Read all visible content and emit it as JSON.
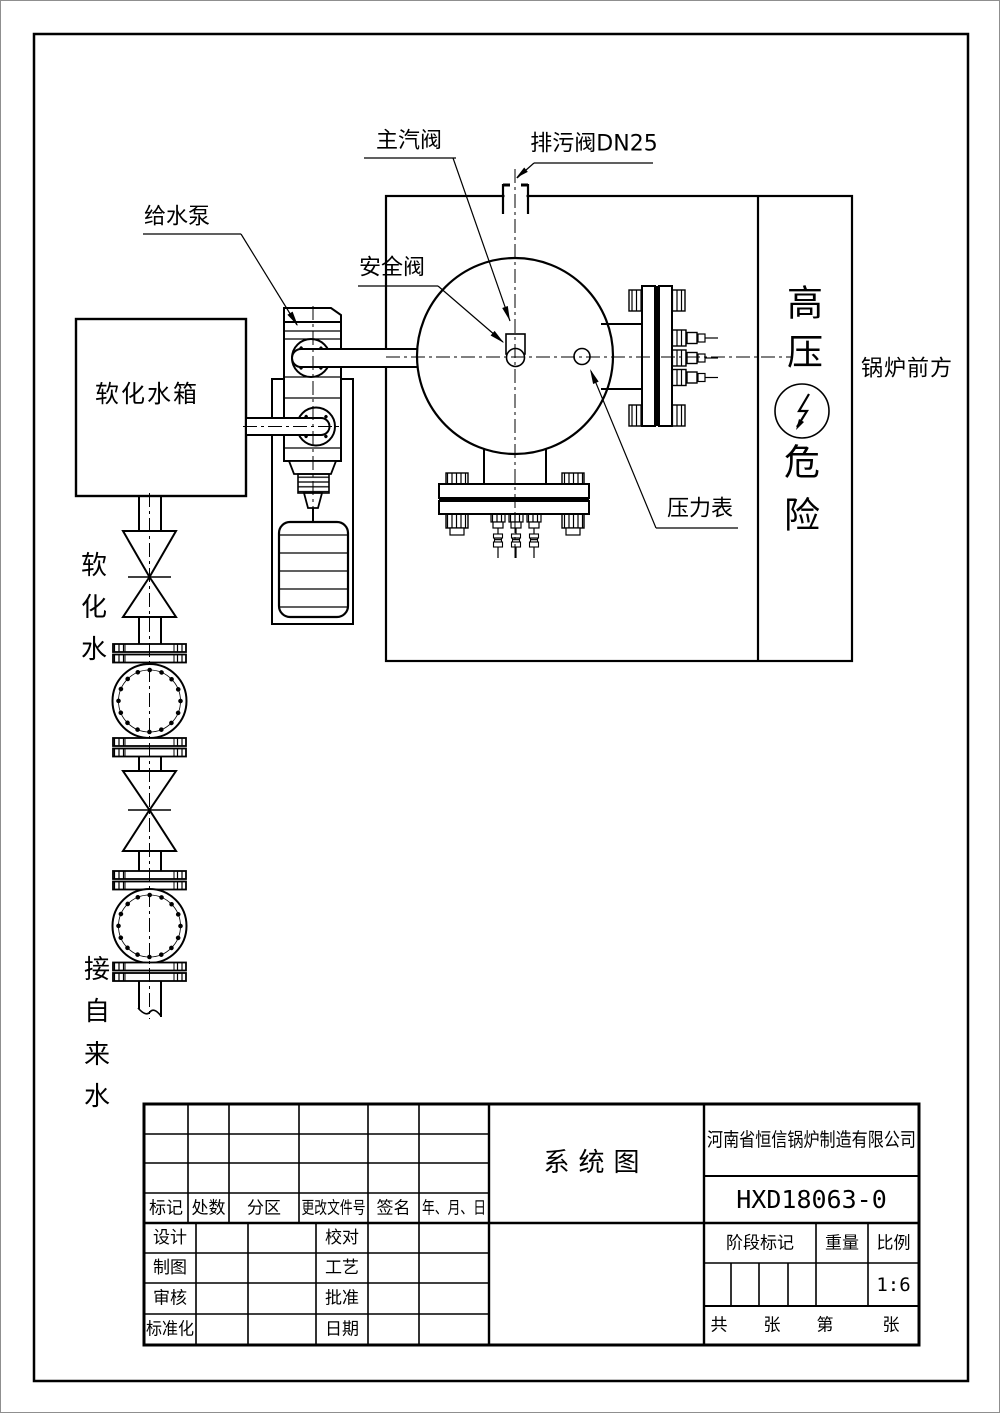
{
  "colors": {
    "line": "#000000",
    "background": "#ffffff"
  },
  "diagram": {
    "labels": {
      "main_steam_valve": "主汽阀",
      "blowdown_valve": "排污阀DN25",
      "feed_water_pump": "给水泵",
      "safety_valve": "安全阀",
      "softened_water_tank": "软化水箱",
      "pressure_gauge": "压力表",
      "boiler_front": "锅炉前方"
    },
    "vertical_labels": {
      "softened_water": [
        "软",
        "化",
        "水"
      ],
      "from_tap_water": [
        "接",
        "自",
        "来",
        "水"
      ],
      "high_pressure_danger": [
        "高",
        "压",
        "危",
        "险"
      ]
    }
  },
  "title_block": {
    "revision_header": [
      "标记",
      "处数",
      "分区",
      "更改文件号",
      "签名",
      "年、月、日"
    ],
    "signature_rows": [
      {
        "left": "设计",
        "right": "校对"
      },
      {
        "left": "制图",
        "right": "工艺"
      },
      {
        "left": "审核",
        "right": "批准"
      },
      {
        "left": "标准化",
        "right": "日期"
      }
    ],
    "drawing_title": "系统图",
    "company": "河南省恒信锅炉制造有限公司",
    "drawing_number": "HXD18063-0",
    "stage_mark_label": "阶段标记",
    "weight_label": "重量",
    "scale_label": "比例",
    "scale_value": "1:6",
    "sheets": {
      "total_label": "共",
      "total_unit": "张",
      "current_label": "第",
      "current_unit": "张"
    }
  }
}
